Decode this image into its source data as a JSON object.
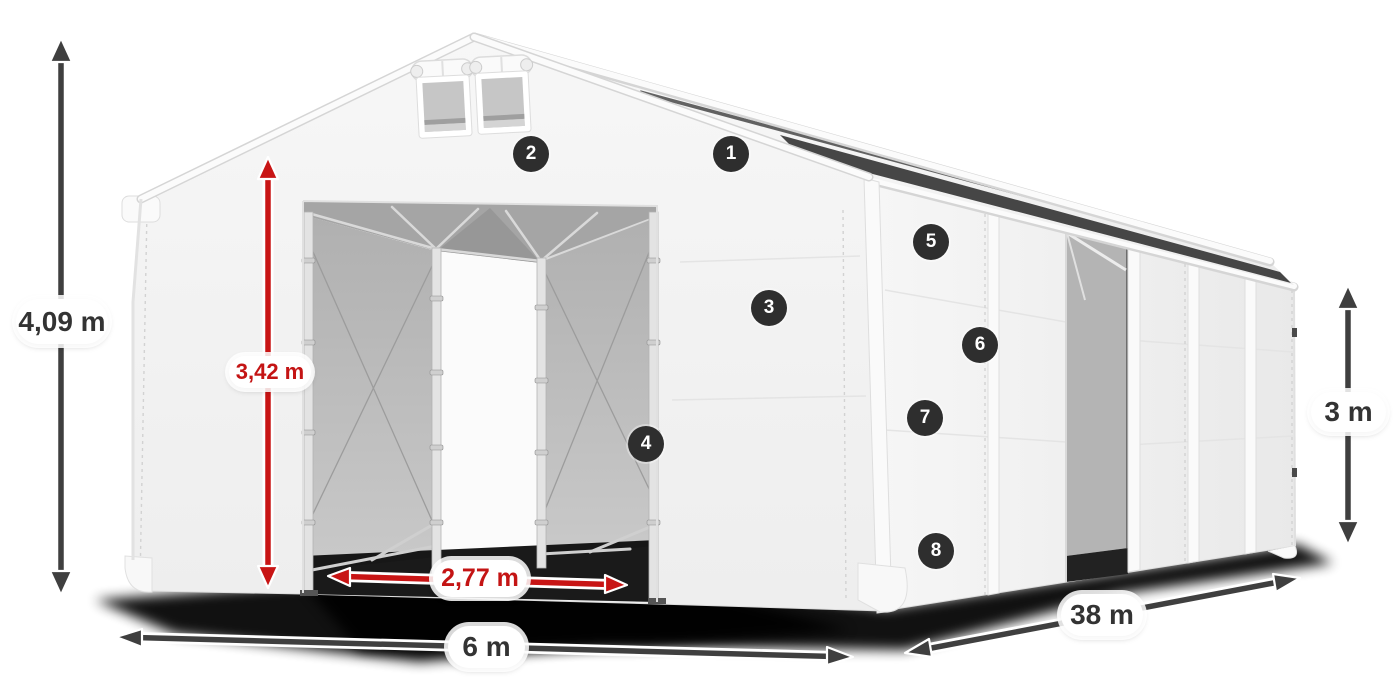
{
  "dimension_labels": {
    "total_height": "4,09 m",
    "entrance_height": "3,42 m",
    "entrance_width": "2,77 m",
    "front_width": "6 m",
    "length": "38 m",
    "side_wall_height": "3 m"
  },
  "callouts": [
    {
      "number": "1"
    },
    {
      "number": "2"
    },
    {
      "number": "3"
    },
    {
      "number": "4"
    },
    {
      "number": "5"
    },
    {
      "number": "6"
    },
    {
      "number": "7"
    },
    {
      "number": "8"
    }
  ],
  "colors": {
    "background": "#ffffff",
    "dimension_arrow": "#3f3f3f",
    "dimension_text": "#333333",
    "red_arrow": "#c81515",
    "red_text": "#c41414",
    "badge_background": "#2e2e2e",
    "badge_text": "#ffffff"
  }
}
